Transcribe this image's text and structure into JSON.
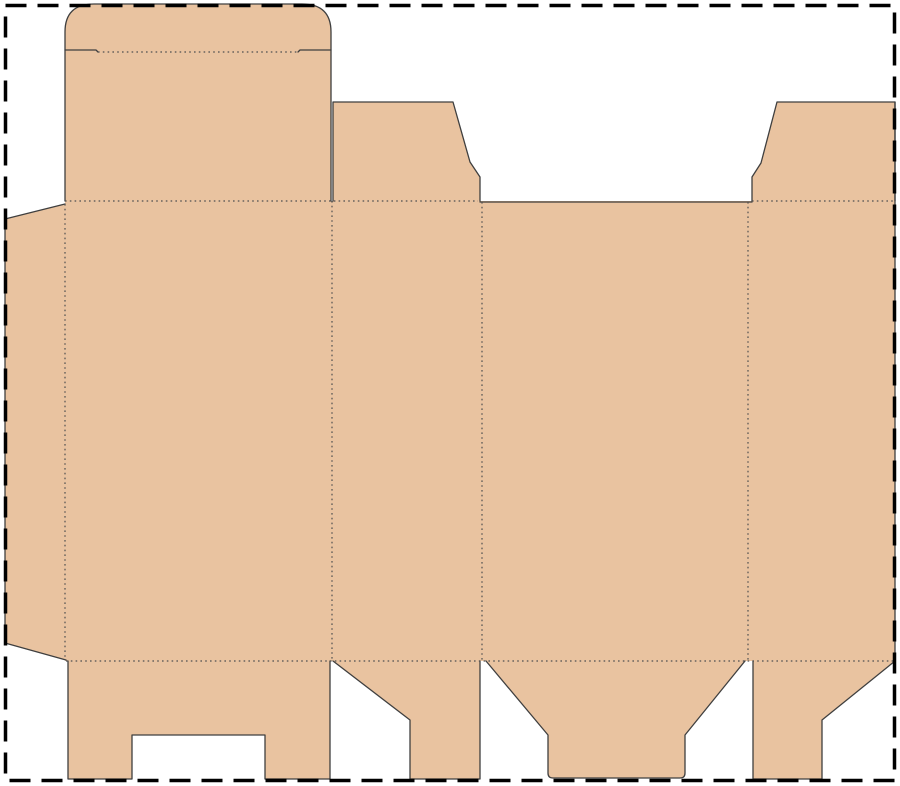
{
  "canvas": {
    "width": 900,
    "height": 786,
    "background": "#ffffff"
  },
  "colors": {
    "board_fill": "#e9c3a0",
    "cut_line": "#3f3f3f",
    "fold_line": "#4f4f4f",
    "sheet_border": "#000000"
  },
  "styles": {
    "cut_width": 1.3,
    "fold_width": 1.2,
    "fold_dash": "1.6 3.2",
    "border_width": 3.5,
    "border_dash": "21 11"
  },
  "sheet_border": {
    "x": 5.5,
    "y": 5.5,
    "width": 889,
    "height": 775
  },
  "dieline": {
    "pieces": [
      {
        "name": "main-panels",
        "stroke": false,
        "path": "M 65 201 L 895 201 L 895 661 L 65 661 Z"
      },
      {
        "name": "lid-tuck-flap",
        "stroke": true,
        "path": "M 65 201 L 65 32 Q 65 4 94 4 L 302 4 Q 331 4 331 32 L 331 201"
      },
      {
        "name": "glue-flap",
        "stroke": true,
        "path": "M 65 204 L 5 219 L 5 643 L 66 660"
      },
      {
        "name": "dust-flap-top-left",
        "stroke": true,
        "path": "M 333 201 L 333 102 L 453 102 L 470 162 L 480 177 L 480 201"
      },
      {
        "name": "dust-flap-top-right",
        "stroke": true,
        "path": "M 752 201 L 752 177 L 761 163 L 777 102 L 895 102 L 895 201"
      },
      {
        "name": "bottom-lock-flap",
        "stroke": true,
        "path": "M 68 661 L 68 779 L 132 779 L 132 735 L 265 735 L 265 779 L 330 779 L 330 661"
      },
      {
        "name": "bottom-flap-left-side",
        "stroke": true,
        "path": "M 333 661 L 410 720 L 410 779 L 480 779 L 480 661"
      },
      {
        "name": "bottom-tuck-flap",
        "stroke": true,
        "path": "M 486 661 L 548 735 L 548 773 Q 548 778 553 778 L 680 778 Q 685 778 685 773 L 685 735 L 745 661"
      },
      {
        "name": "bottom-flap-right-side",
        "stroke": true,
        "path": "M 895 661 L 822 720 L 822 779 L 753 779 L 753 661"
      }
    ],
    "cut_only_paths": [
      {
        "name": "tuck-shoulder-left",
        "path": "M 65 50 L 96 50 L 98 52"
      },
      {
        "name": "tuck-shoulder-right",
        "path": "M 298 52 L 300 50 L 331 50"
      },
      {
        "name": "back-panel-top-edge",
        "path": "M 480 202 L 752 202"
      },
      {
        "name": "right-panel-edge",
        "path": "M 895 102 L 895 661"
      }
    ],
    "fold_lines": [
      {
        "name": "tuck-flap-fold",
        "x1": 98,
        "y1": 52,
        "x2": 298,
        "y2": 52
      },
      {
        "name": "top-fold-left",
        "x1": 65,
        "y1": 201,
        "x2": 478,
        "y2": 201
      },
      {
        "name": "top-fold-right",
        "x1": 752,
        "y1": 201,
        "x2": 895,
        "y2": 201
      },
      {
        "name": "bottom-fold",
        "x1": 66,
        "y1": 661,
        "x2": 895,
        "y2": 661
      },
      {
        "name": "glue-flap-fold",
        "x1": 65,
        "y1": 204,
        "x2": 65,
        "y2": 660
      },
      {
        "name": "panel-fold-1",
        "x1": 332,
        "y1": 201,
        "x2": 332,
        "y2": 661
      },
      {
        "name": "panel-fold-2",
        "x1": 482,
        "y1": 202,
        "x2": 482,
        "y2": 661
      },
      {
        "name": "panel-fold-3",
        "x1": 748,
        "y1": 202,
        "x2": 748,
        "y2": 661
      }
    ]
  }
}
